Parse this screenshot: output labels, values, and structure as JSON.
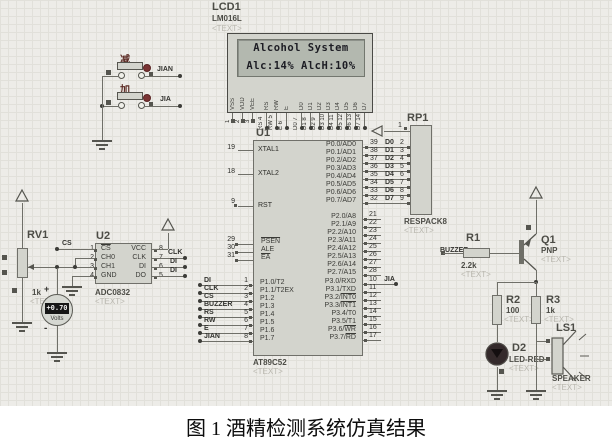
{
  "caption": "图 1 酒精检测系统仿真结果",
  "colors": {
    "canvas_bg": "#edece8",
    "grid_line": "#e1e0da",
    "component_fill": "#d3d4cd",
    "component_border": "#70706a",
    "wire": "#6f6f68",
    "button_red": "#7a3434",
    "lcd_screen": "#b3b8af",
    "meter_display_bg": "#161616",
    "meter_display_text": "#ececec"
  },
  "lcd": {
    "ref": "LCD1",
    "part": "LM016L",
    "placeholder": "<TEXT>",
    "line1": "Alcohol System",
    "line2": "Alc:14% AlcH:10%",
    "pins_power": [
      {
        "num": "1",
        "name": "VSS"
      },
      {
        "num": "2",
        "name": "VDD"
      },
      {
        "num": "3",
        "name": "VEE"
      }
    ],
    "pins_ctrl": [
      {
        "num": "4",
        "name": "RS"
      },
      {
        "num": "5",
        "name": "RW"
      },
      {
        "num": "6",
        "name": "E"
      }
    ],
    "pins_data": [
      {
        "num": "7",
        "name": "D0"
      },
      {
        "num": "8",
        "name": "D1"
      },
      {
        "num": "9",
        "name": "D2"
      },
      {
        "num": "10",
        "name": "D3"
      },
      {
        "num": "11",
        "name": "D4"
      },
      {
        "num": "12",
        "name": "D5"
      },
      {
        "num": "13",
        "name": "D6"
      },
      {
        "num": "14",
        "name": "D7"
      }
    ]
  },
  "mcu": {
    "ref": "U1",
    "part": "AT89C52",
    "placeholder": "<TEXT>",
    "xtal_pins": [
      {
        "num": "19",
        "name": "XTAL1"
      },
      {
        "num": "18",
        "name": "XTAL2"
      },
      {
        "num": "9",
        "name": "RST"
      }
    ],
    "ctrl_pins": [
      {
        "num": "29",
        "pre": "",
        "bar": "PSEN"
      },
      {
        "num": "30",
        "pre": "ALE",
        "bar": ""
      },
      {
        "num": "31",
        "pre": "",
        "bar": "EA"
      }
    ],
    "p1_pins": [
      {
        "net": "DI",
        "num": "1",
        "name": "P1.0/T2"
      },
      {
        "net": "CLK",
        "num": "2",
        "name": "P1.1/T2EX"
      },
      {
        "net": "CS",
        "num": "3",
        "name": "P1.2"
      },
      {
        "net": "BUZZER",
        "num": "4",
        "name": "P1.3"
      },
      {
        "net": "RS",
        "num": "5",
        "name": "P1.4"
      },
      {
        "net": "RW",
        "num": "6",
        "name": "P1.5"
      },
      {
        "net": "E",
        "num": "7",
        "name": "P1.6"
      },
      {
        "net": "JIAN",
        "num": "8",
        "name": "P1.7"
      }
    ],
    "p0_pins": [
      {
        "num": "39",
        "name": "P0.0/AD0",
        "net": "D0",
        "rp": "2"
      },
      {
        "num": "38",
        "name": "P0.1/AD1",
        "net": "D1",
        "rp": "3"
      },
      {
        "num": "37",
        "name": "P0.2/AD2",
        "net": "D2",
        "rp": "4"
      },
      {
        "num": "36",
        "name": "P0.3/AD3",
        "net": "D3",
        "rp": "5"
      },
      {
        "num": "35",
        "name": "P0.4/AD4",
        "net": "D4",
        "rp": "6"
      },
      {
        "num": "34",
        "name": "P0.5/AD5",
        "net": "D5",
        "rp": "7"
      },
      {
        "num": "33",
        "name": "P0.6/AD6",
        "net": "D6",
        "rp": "8"
      },
      {
        "num": "32",
        "name": "P0.7/AD7",
        "net": "D7",
        "rp": "9"
      }
    ],
    "p2_pins": [
      {
        "num": "21",
        "name": "P2.0/A8"
      },
      {
        "num": "22",
        "name": "P2.1/A9"
      },
      {
        "num": "23",
        "name": "P2.2/A10"
      },
      {
        "num": "24",
        "name": "P2.3/A11"
      },
      {
        "num": "25",
        "name": "P2.4/A12"
      },
      {
        "num": "26",
        "name": "P2.5/A13"
      },
      {
        "num": "27",
        "name": "P2.6/A14"
      },
      {
        "num": "28",
        "name": "P2.7/A15"
      }
    ],
    "p3_pins": [
      {
        "num": "10",
        "pre": "P3.0/RXD",
        "bar": "",
        "net": "JIA"
      },
      {
        "num": "11",
        "pre": "P3.1/TXD",
        "bar": ""
      },
      {
        "num": "12",
        "pre": "P3.2/",
        "bar": "INT0"
      },
      {
        "num": "13",
        "pre": "P3.3/",
        "bar": "INT1"
      },
      {
        "num": "14",
        "pre": "P3.4/T0",
        "bar": ""
      },
      {
        "num": "15",
        "pre": "P3.5/T1",
        "bar": ""
      },
      {
        "num": "16",
        "pre": "P3.6/",
        "bar": "WR"
      },
      {
        "num": "17",
        "pre": "P3.7/",
        "bar": "RD"
      }
    ]
  },
  "respack": {
    "ref": "RP1",
    "part": "RESPACK8",
    "placeholder": "<TEXT>",
    "pin1_num": "1"
  },
  "adc": {
    "ref": "U2",
    "part": "ADC0832",
    "placeholder": "<TEXT>",
    "left_pins": [
      {
        "num": "1",
        "pre": "",
        "bar": "CS"
      },
      {
        "num": "2",
        "pre": "CH0",
        "bar": ""
      },
      {
        "num": "3",
        "pre": "CH1",
        "bar": ""
      },
      {
        "num": "4",
        "pre": "GND",
        "bar": ""
      }
    ],
    "right_pins": [
      {
        "num": "8",
        "name": "VCC"
      },
      {
        "num": "7",
        "name": "CLK"
      },
      {
        "num": "6",
        "name": "DI"
      },
      {
        "num": "5",
        "name": "DO"
      }
    ],
    "cs_net": "CS",
    "right_nets": [
      "CLK",
      "DI",
      "DI"
    ]
  },
  "pot": {
    "ref": "RV1",
    "value": "1k",
    "placeholder": "<TEXT>"
  },
  "meter": {
    "reading": "+0.70",
    "unit": "Volts",
    "plus": "+",
    "minus": "-"
  },
  "keys": {
    "items": [
      {
        "glyph": "减",
        "net": "JIAN"
      },
      {
        "glyph": "加",
        "net": "JIA"
      }
    ]
  },
  "r1": {
    "ref": "R1",
    "value": "2.2k",
    "net": "BUZZER",
    "placeholder": "<TEXT>"
  },
  "q1": {
    "ref": "Q1",
    "value": "PNP",
    "placeholder": "<TEXT>"
  },
  "r2": {
    "ref": "R2",
    "value": "100",
    "placeholder": "<TEXT>"
  },
  "r3": {
    "ref": "R3",
    "value": "1k",
    "placeholder": "<TEXT>"
  },
  "d2": {
    "ref": "D2",
    "part": "LED-RED",
    "placeholder": "<TEXT>"
  },
  "ls1": {
    "ref": "LS1",
    "part": "SPEAKER",
    "placeholder": "<TEXT>"
  }
}
